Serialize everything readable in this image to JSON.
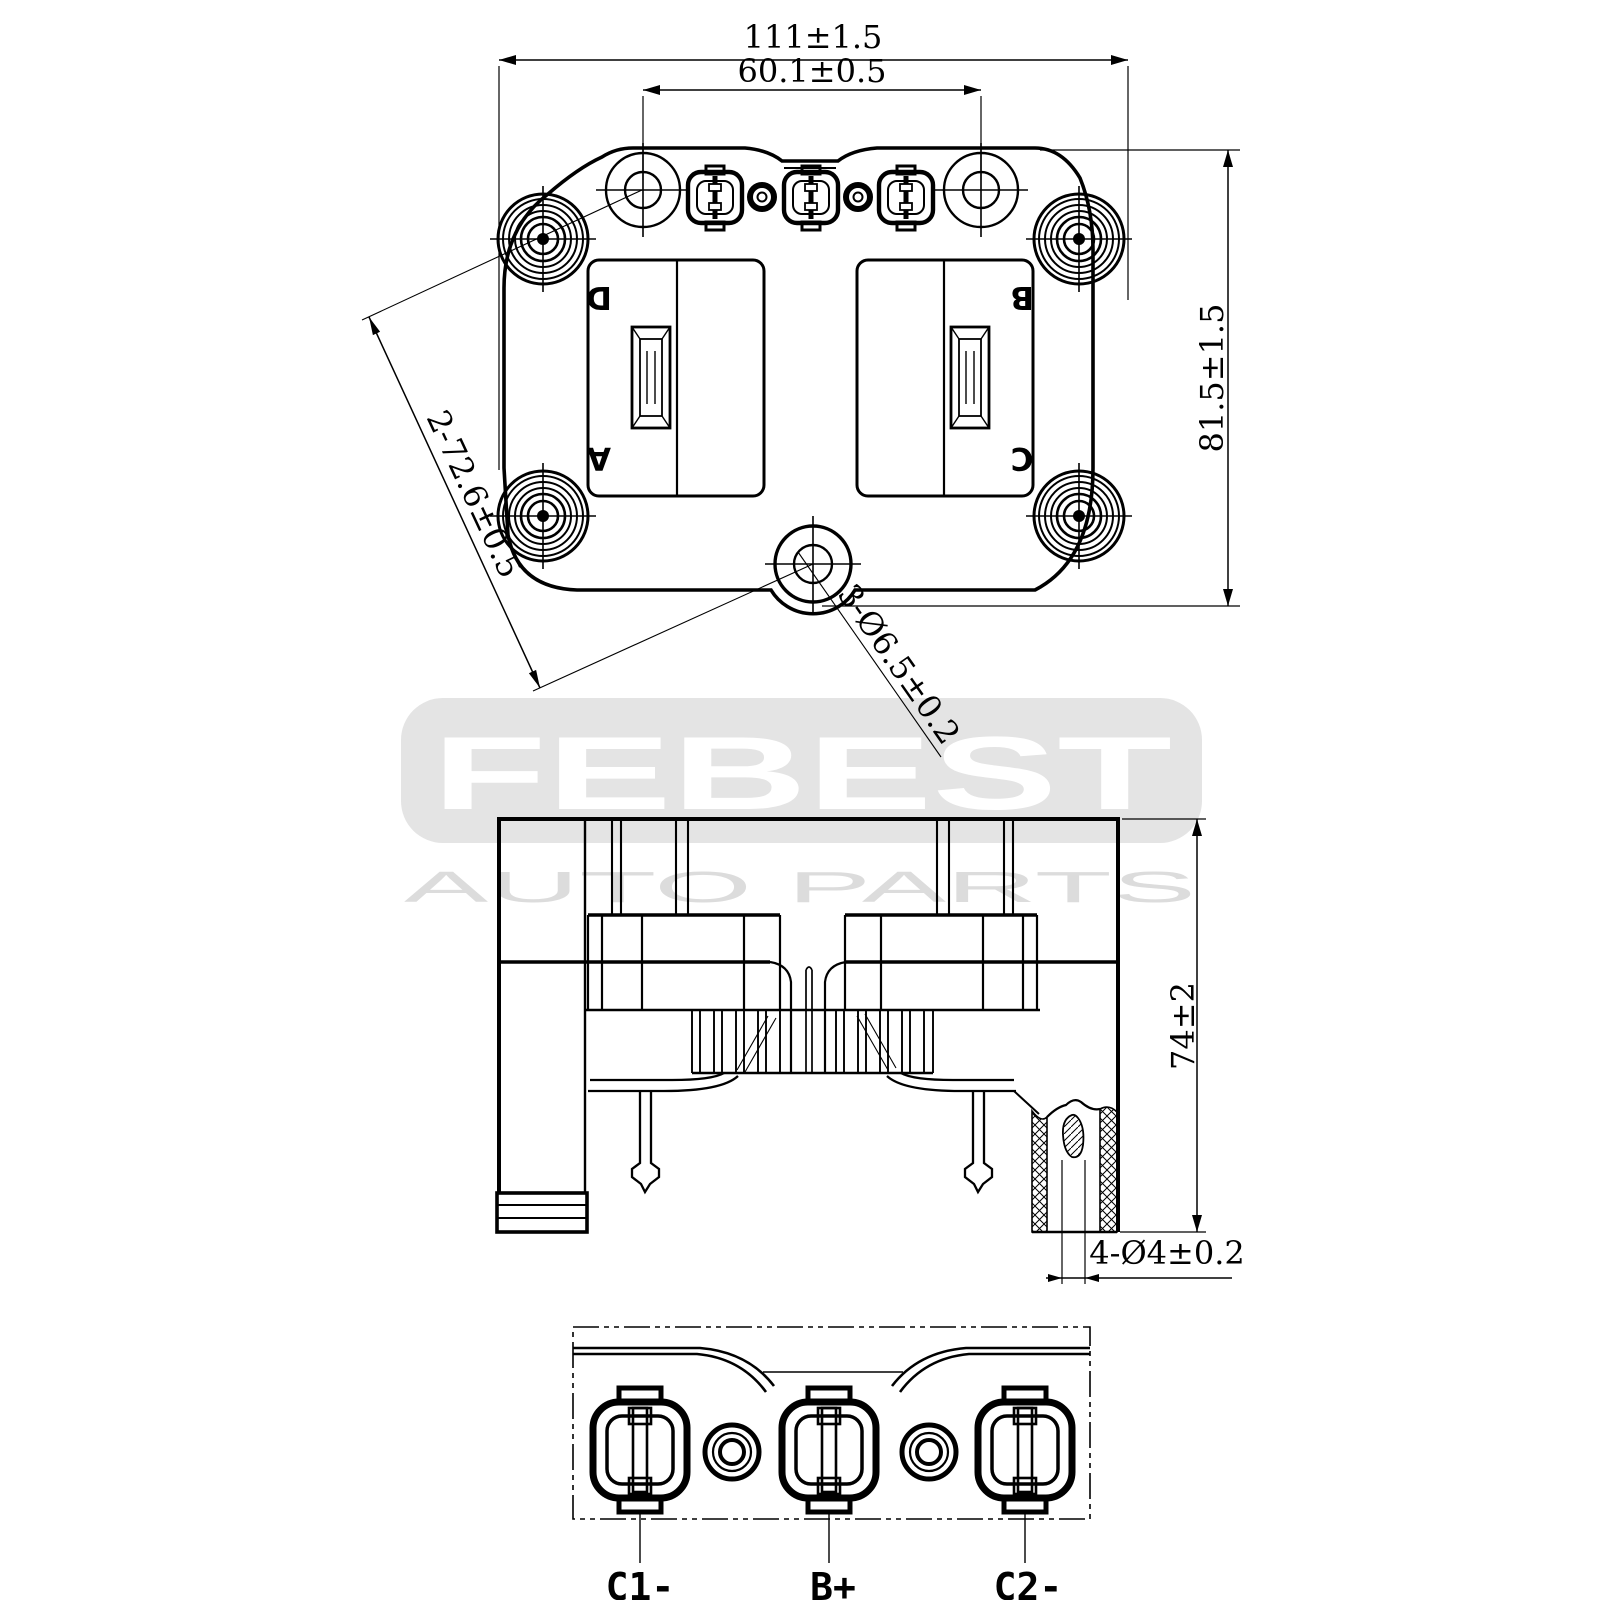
{
  "watermark": {
    "brand": "FEBEST",
    "tagline": "AUTO PARTS"
  },
  "plan_view": {
    "dim_width": "111±1.5",
    "dim_hole_pitch": "60.1±0.5",
    "dim_height": "81.5±1.5",
    "dim_diagonal_pitch": "2-72.6±0.5",
    "dim_mount_hole": "3-Ø6.5±0.2",
    "labels": {
      "d": "D",
      "a": "A",
      "b": "B",
      "c": "C"
    }
  },
  "side_view": {
    "dim_height": "74±2",
    "dim_output_hole": "4-Ø4±0.2"
  },
  "bottom_view": {
    "terminals": [
      {
        "label": "C1-"
      },
      {
        "label": "B+"
      },
      {
        "label": "C2-"
      }
    ]
  }
}
